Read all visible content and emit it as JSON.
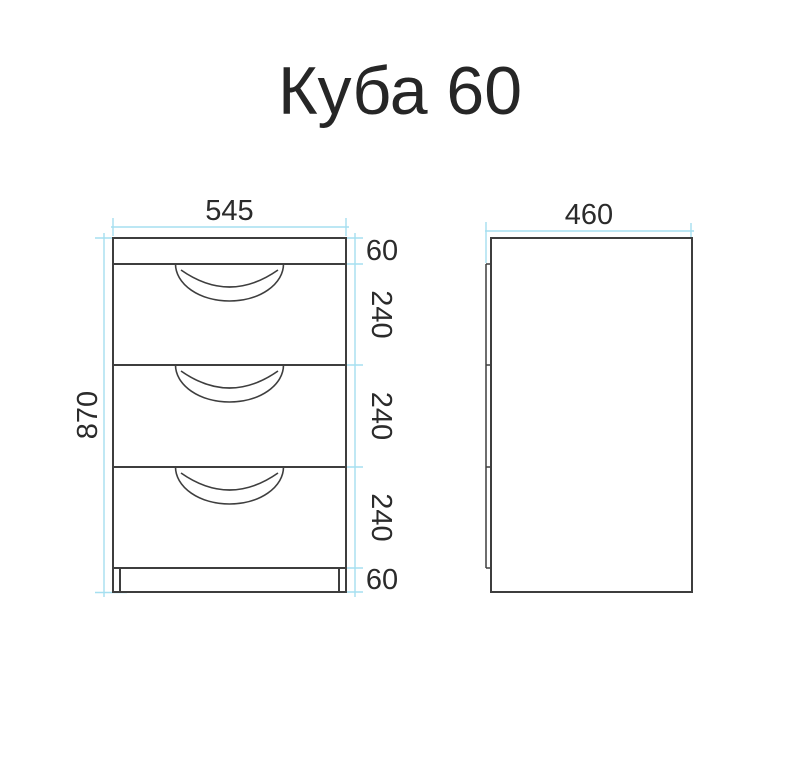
{
  "page": {
    "title": "Куба 60"
  },
  "colors": {
    "outline": "#3e3e3e",
    "dimension_line": "#a5dff0",
    "dimension_text": "#2b2b2b"
  },
  "front_view": {
    "width": "545",
    "height": "870",
    "sections": [
      "60",
      "240",
      "240",
      "240",
      "60"
    ]
  },
  "side_view": {
    "depth": "460"
  }
}
